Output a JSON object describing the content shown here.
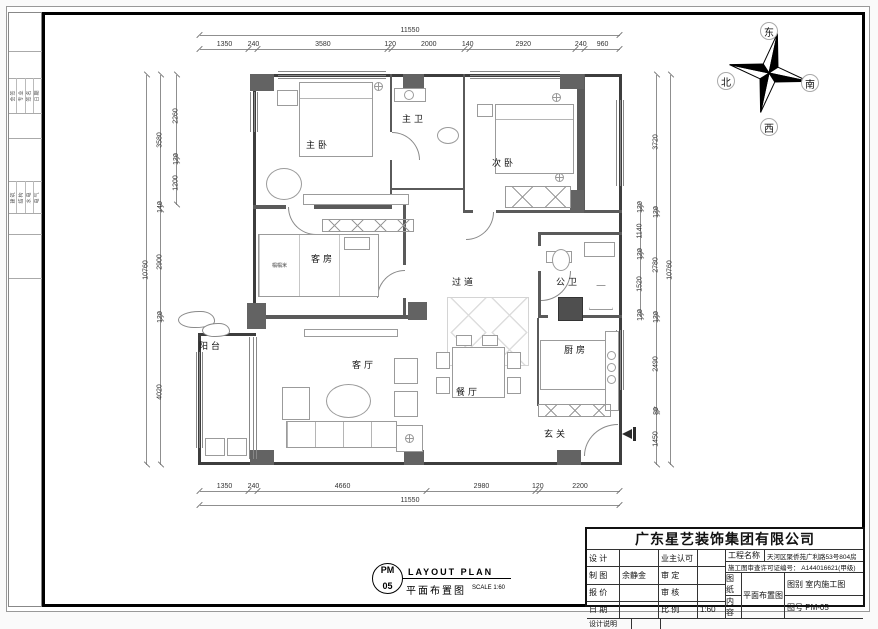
{
  "compass": {
    "east": "东",
    "north": "北",
    "south": "南",
    "west": "西"
  },
  "rooms": {
    "master_bedroom": "主卧",
    "master_bath": "主卫",
    "second_bedroom": "次卧",
    "guest_room": "客房",
    "tatami": "榻榻米",
    "corridor": "过道",
    "public_bath": "公卫",
    "kitchen": "厨房",
    "balcony": "阳台",
    "living_room": "客厅",
    "dining_room": "餐厅",
    "entry": "玄关"
  },
  "dims": {
    "top_total": [
      "11550"
    ],
    "top": [
      "1350",
      "240",
      "3580",
      "120",
      "2000",
      "140",
      "2920",
      "240",
      "960"
    ],
    "bottom": [
      "1350",
      "240",
      "4660",
      "2980",
      "120",
      "2200"
    ],
    "bottom_total": [
      "11550"
    ],
    "left_total": [
      "10760"
    ],
    "left_mid": [
      "3580",
      "140",
      "2900",
      "120",
      "4020"
    ],
    "left_inner": [
      "2260",
      "120",
      "1200"
    ],
    "right_inner": [
      "120",
      "1140",
      "120",
      "1520",
      "120"
    ],
    "right_mid": [
      "3720",
      "120",
      "2780",
      "120",
      "2490",
      "80",
      "1450"
    ],
    "right_total": [
      "10760"
    ]
  },
  "margin": {
    "group1": [
      "会签",
      "专业",
      "签名",
      "日期"
    ],
    "group2": [
      "建筑",
      "结构",
      "水电",
      "电气"
    ]
  },
  "drawing_title": {
    "code_top": "PM",
    "code_bottom": "05",
    "title_en": "LAYOUT PLAN",
    "title_cn": "平面布置图",
    "scale": "SCALE 1:60"
  },
  "title_block": {
    "company": "广东星艺装饰集团有限公司",
    "rows": [
      {
        "l1": "设 计",
        "v1": "",
        "l2": "业主认可",
        "v2": ""
      },
      {
        "l1": "制 图",
        "v1": "余静金",
        "l2": "审 定",
        "v2": ""
      },
      {
        "l1": "报 价",
        "v1": "",
        "l2": "审 核",
        "v2": ""
      },
      {
        "l1": "日 期",
        "v1": "",
        "l2": "比 例",
        "v2": "1:60"
      }
    ],
    "project_label": "工程名称",
    "project_value": "天河区聚侨苑广利路53号804房",
    "license": "施工图审查许可证编号： A144016621(甲级)",
    "paper_label": "图 纸",
    "content_label": "内 容",
    "content_value": "平面布置图",
    "category_label": "图别",
    "category_value": "室内施工图",
    "number_label": "图号",
    "number_value": "PM-05",
    "notes_label": "设计说明"
  },
  "colors": {
    "wall": "#3d3d3d",
    "column": "#636363",
    "dim_text": "#333333",
    "frame": "#000000"
  }
}
